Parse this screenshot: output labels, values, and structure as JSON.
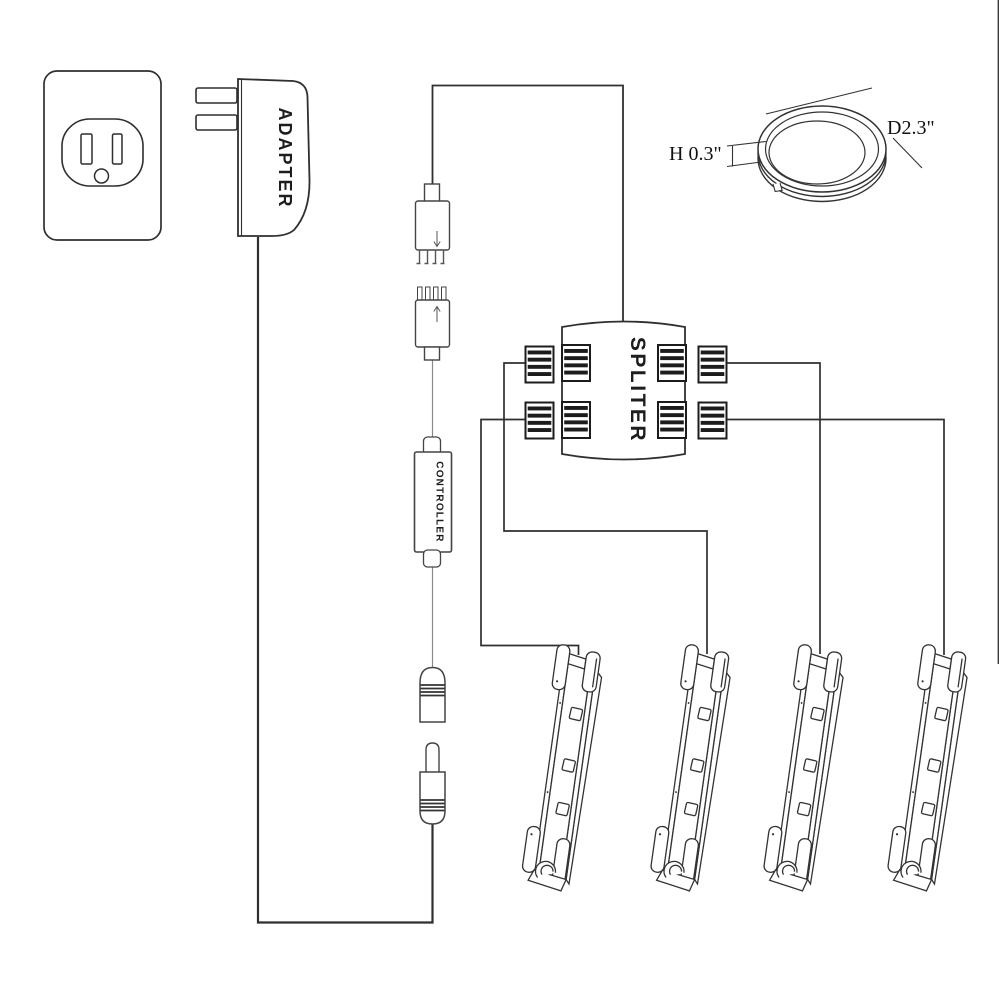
{
  "diagram": {
    "background": "#ffffff",
    "line_color": "#2f2f2f",
    "stripe_color": "#1c1c1c",
    "labels": {
      "adapter": "ADAPTER",
      "splitter": "SPLITER",
      "controller": "CONTROLLER"
    },
    "dimensions": {
      "puck_height": "H 0.3\"",
      "puck_diameter": "D2.3\""
    },
    "components": {
      "wall_outlet": 1,
      "power_adapter": 1,
      "four_pin_male_connector": 1,
      "four_pin_female_connector": 1,
      "controller": 1,
      "dc_jack": 1,
      "dc_plug": 1,
      "splitter_ports": 8,
      "light_bars": 4,
      "leds_per_bar": 3,
      "puck_light": 1
    }
  }
}
